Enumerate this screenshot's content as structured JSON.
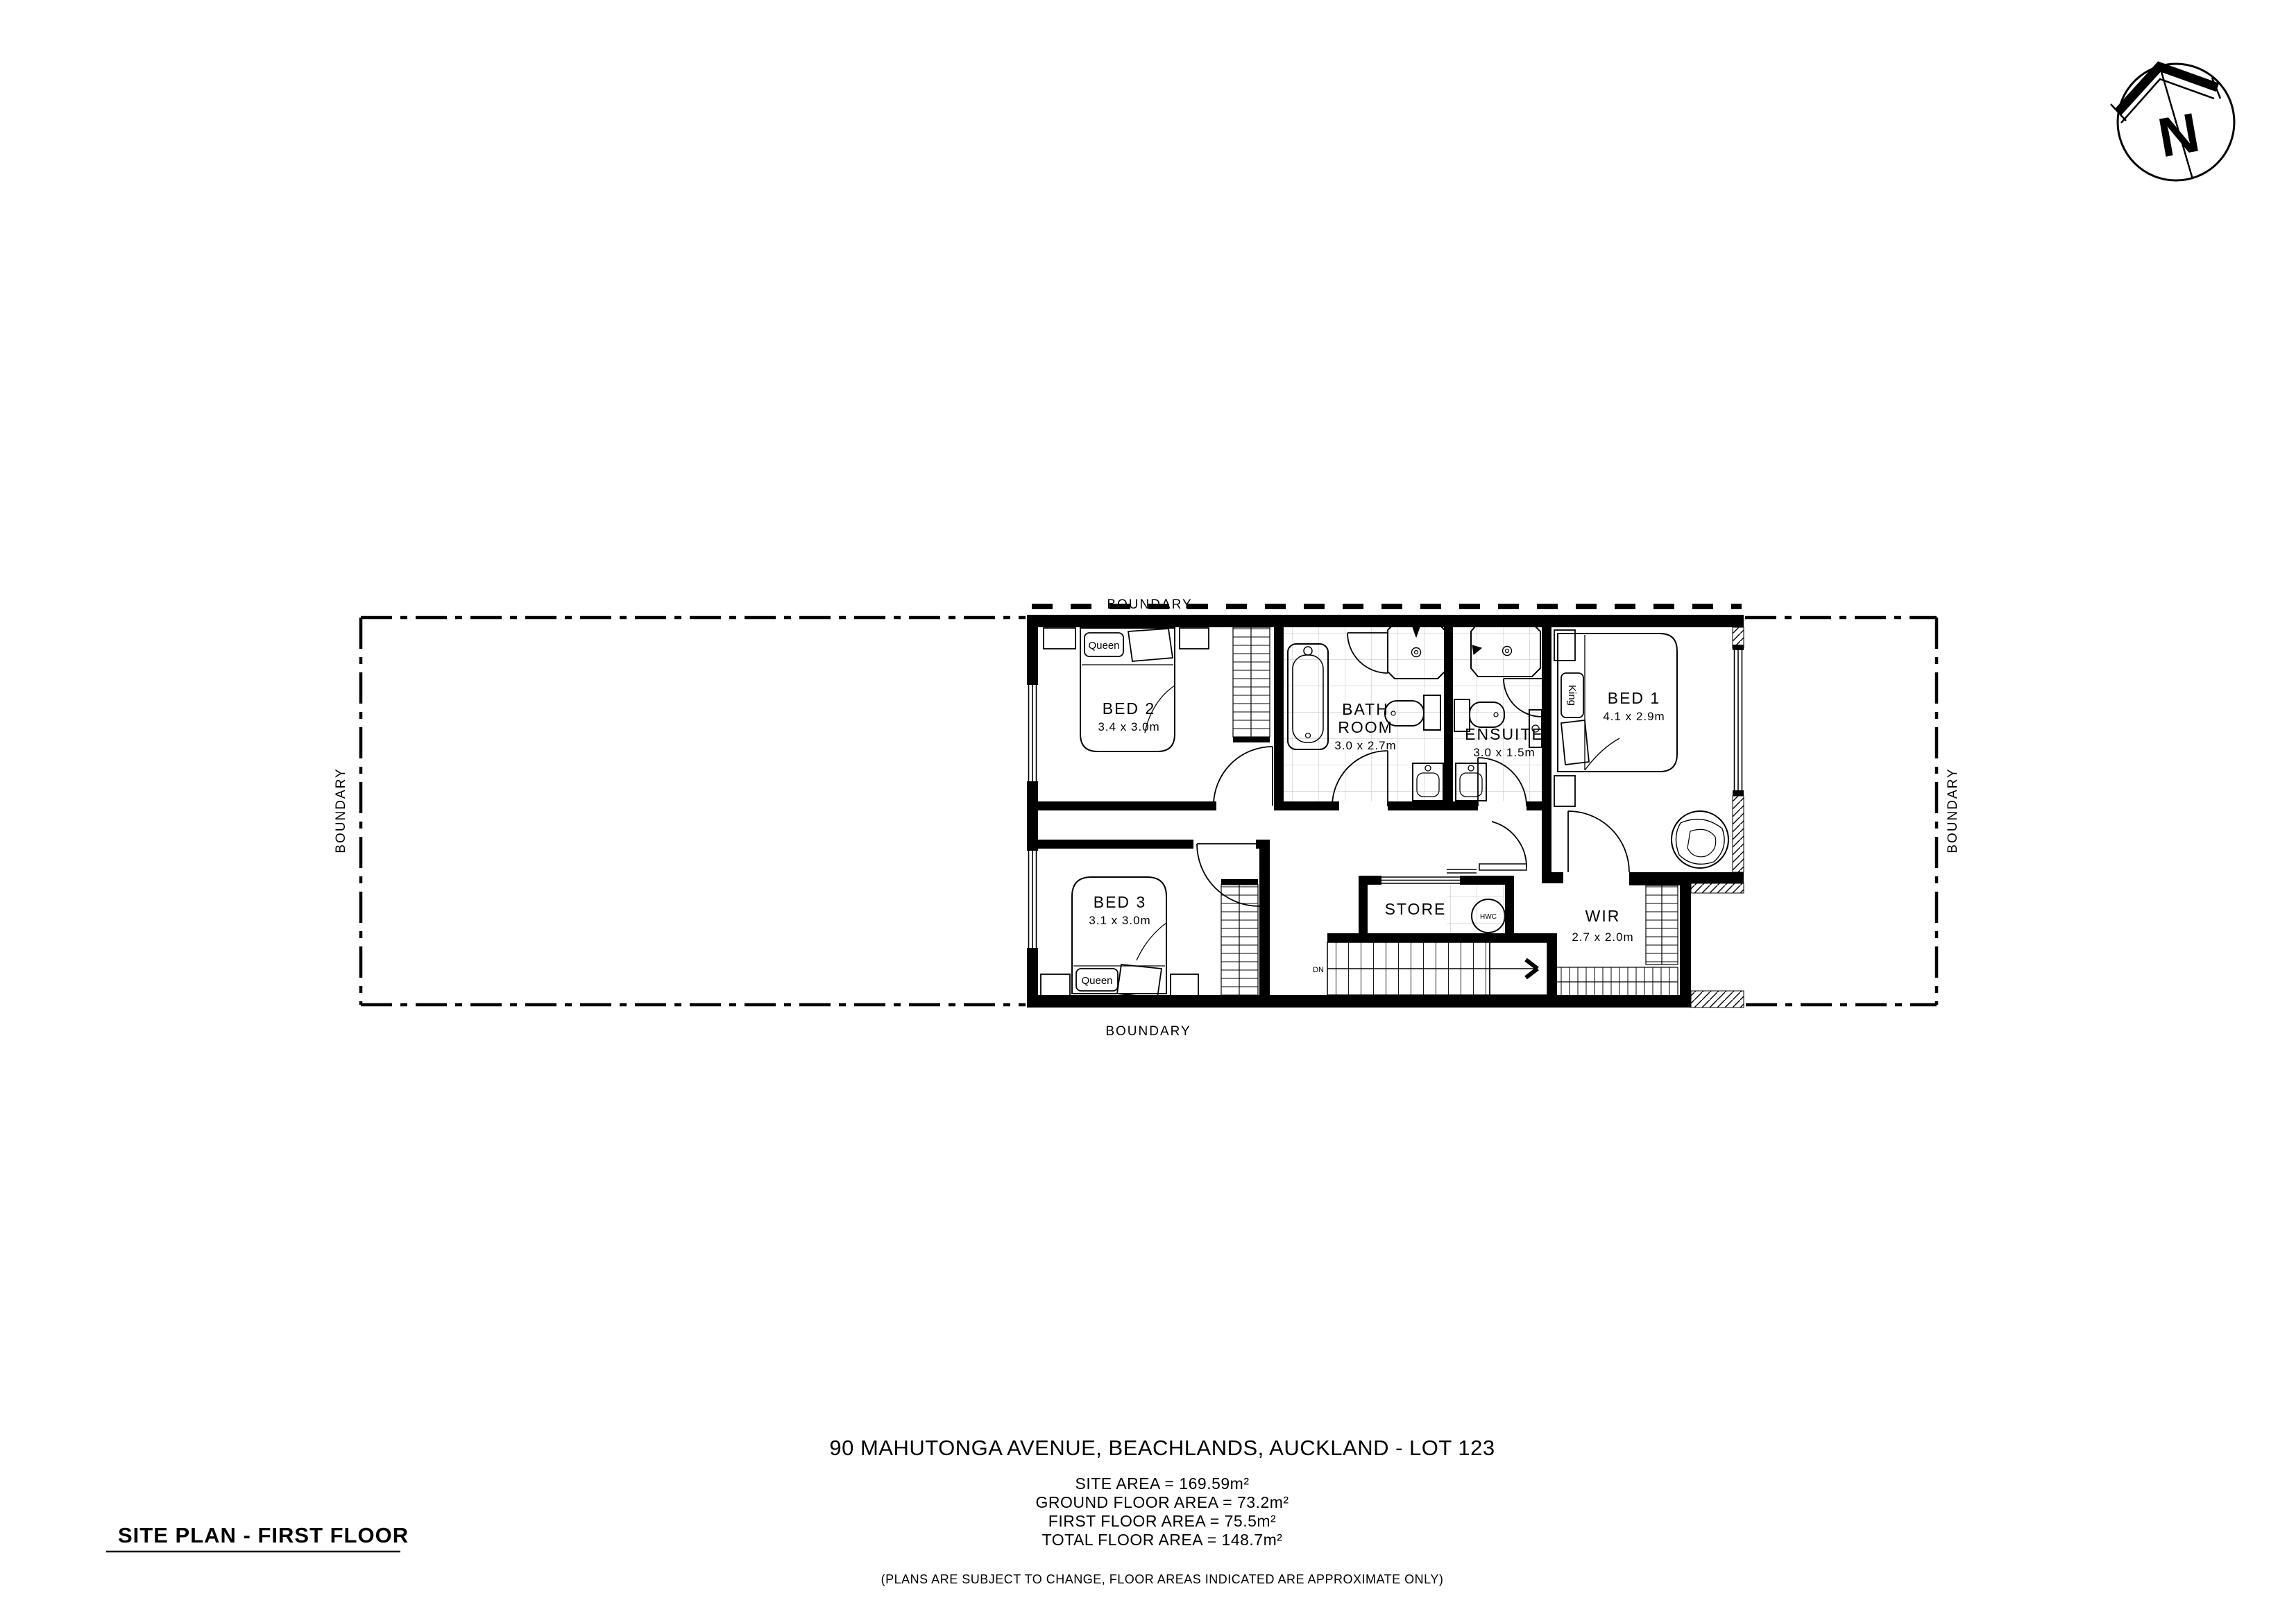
{
  "compass": {
    "letter": "N"
  },
  "boundary": {
    "top": "BOUNDARY",
    "bottom": "BOUNDARY",
    "left": "BOUNDARY",
    "right": "BOUNDARY"
  },
  "rooms": {
    "bed2": {
      "name": "BED 2",
      "dims": "3.4 x 3.0m",
      "bed_label": "Queen"
    },
    "bathroom": {
      "name_line1": "BATH",
      "name_line2": "ROOM",
      "dims": "3.0 x 2.7m"
    },
    "ensuite": {
      "name": "ENSUITE",
      "dims": "3.0 x 1.5m"
    },
    "bed1": {
      "name": "BED 1",
      "dims": "4.1 x 2.9m",
      "bed_label": "King"
    },
    "bed3": {
      "name": "BED 3",
      "dims": "3.1 x 3.0m",
      "bed_label": "Queen"
    },
    "store": {
      "name": "STORE",
      "hwc_label": "HWC"
    },
    "wir": {
      "name": "WIR",
      "dims": "2.7 x 2.0m"
    }
  },
  "stairs": {
    "down_label": "DN"
  },
  "footer": {
    "address": "90 MAHUTONGA AVENUE, BEACHLANDS, AUCKLAND - LOT 123",
    "site_area": "SITE AREA = 169.59m²",
    "ground_floor_area": "GROUND FLOOR AREA = 73.2m²",
    "first_floor_area": "FIRST FLOOR AREA = 75.5m²",
    "total_floor_area": "TOTAL FLOOR AREA = 148.7m²",
    "disclaimer": "(PLANS ARE SUBJECT TO CHANGE, FLOOR AREAS INDICATED ARE APPROXIMATE ONLY)"
  },
  "title": "SITE PLAN - FIRST FLOOR",
  "colors": {
    "ink": "#000000",
    "paper": "#ffffff",
    "tile": "#c9c9c9"
  }
}
